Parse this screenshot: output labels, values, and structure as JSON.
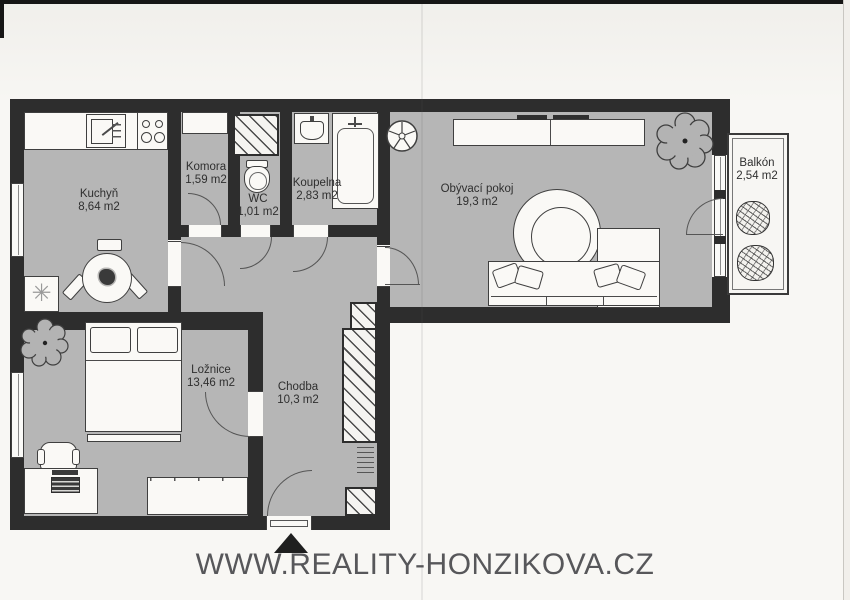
{
  "watermark": {
    "text": "WWW.REALITY-HONZIKOVA.CZ"
  },
  "rooms": {
    "kuchyn": {
      "name": "Kuchyň",
      "area": "8,64 m2"
    },
    "komora": {
      "name": "Komora",
      "area": "1,59 m2"
    },
    "wc": {
      "name": "WC",
      "area": "1,01 m2"
    },
    "koupelna": {
      "name": "Koupelna",
      "area": "2,83 m2"
    },
    "obyvaci_pokoj": {
      "name": "Obývací pokoj",
      "area": "19,3 m2"
    },
    "balkon": {
      "name": "Balkón",
      "area": "2,54 m2"
    },
    "loznice": {
      "name": "Ložnice",
      "area": "13,46 m2"
    },
    "chodba": {
      "name": "Chodba",
      "area": "10,3 m2"
    }
  },
  "icons": {
    "fridge_glyph": "✳"
  },
  "colors": {
    "wall": "#2d2d2d",
    "floor": "#b6b6b6",
    "furniture": "#faf9f6",
    "line": "#3f3f3f",
    "label_text": "#2f2f2f",
    "watermark_text": "#57575a",
    "paper": "#f8f7f4"
  }
}
